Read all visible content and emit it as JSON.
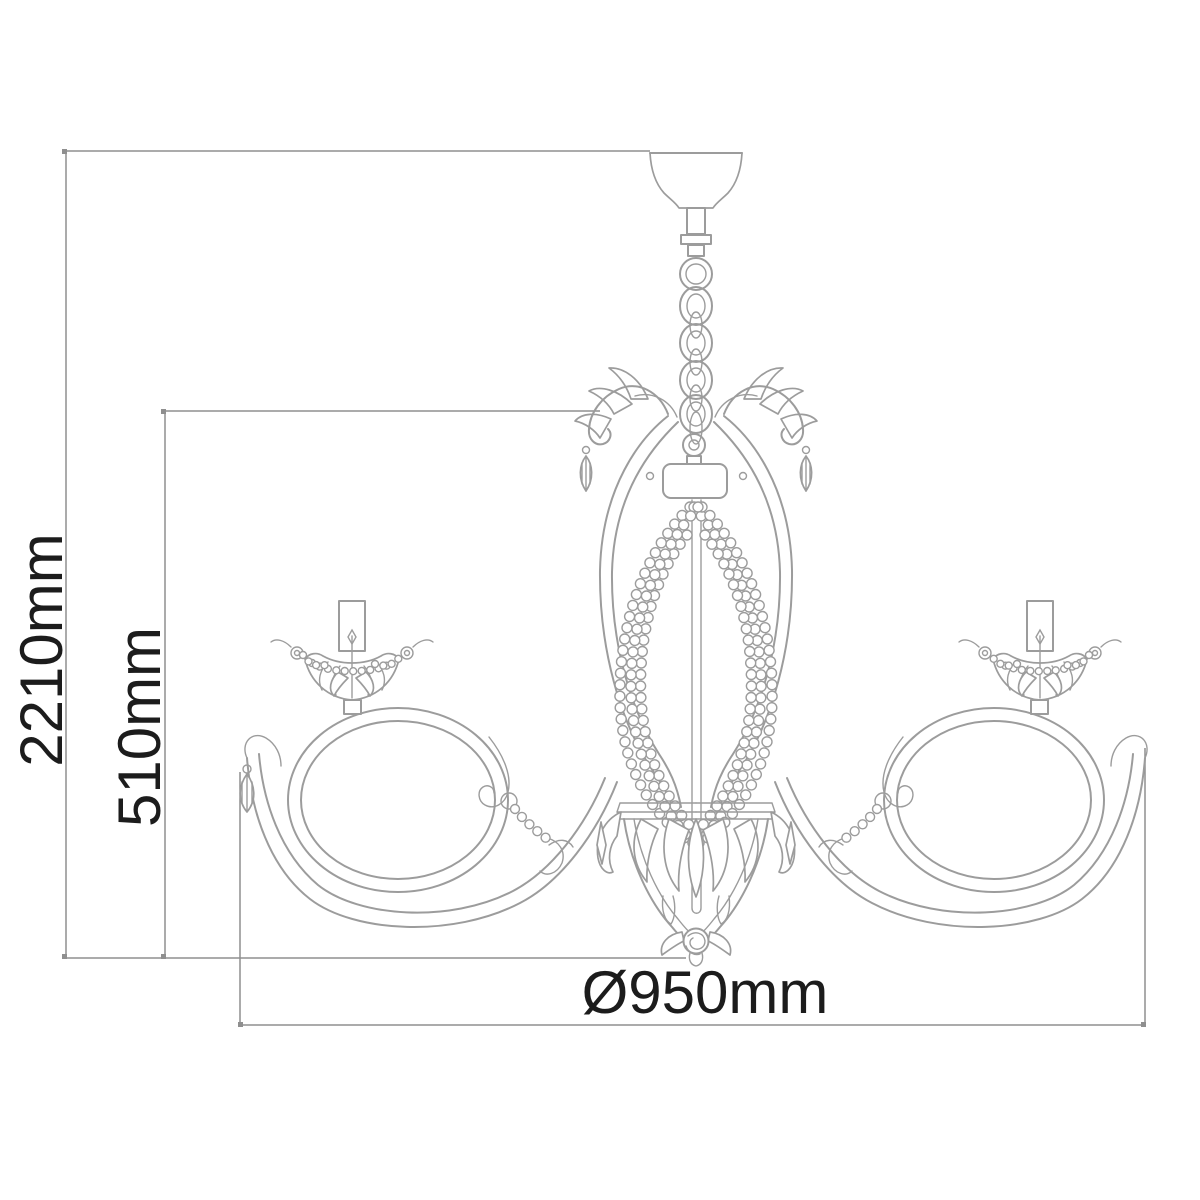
{
  "diagram": {
    "subject": "chandelier-technical-dimension-drawing",
    "style": "line-art",
    "dimensions": {
      "overall_height": "2210mm",
      "drop_height": "510mm",
      "diameter": "Ø950mm"
    },
    "colors": {
      "background": "#ffffff",
      "artwork_line": "#9c9c9c",
      "dimension_line": "#8f8f8f",
      "label_text": "#1c1c1c"
    }
  }
}
